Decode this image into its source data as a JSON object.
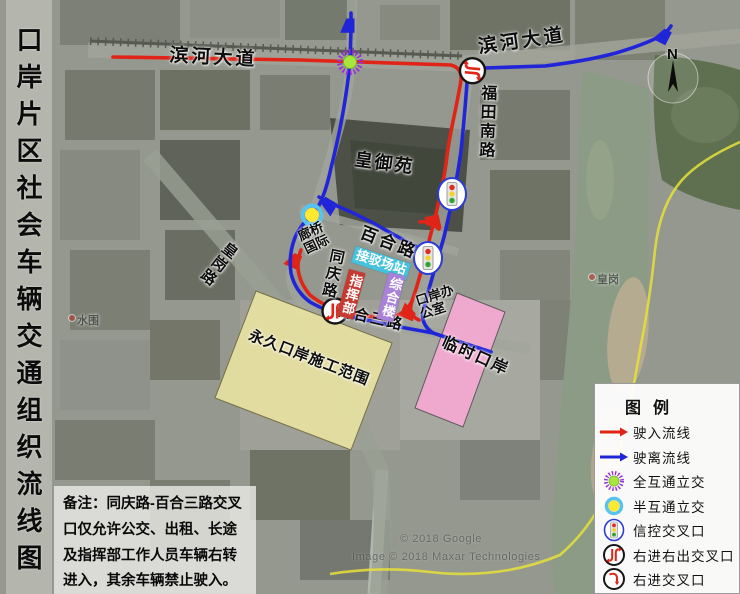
{
  "title": {
    "text": "口岸片区社会车辆交通组织流线图"
  },
  "roads": {
    "binhe_west": "滨河大道",
    "binhe_east": "滨河大道",
    "futian_south": "福田南路",
    "baihe": "百合路",
    "tongqing": "同庆路",
    "huanggang": "皇岗路",
    "baihe_3rd": "百合三路"
  },
  "places": {
    "huangyuyuan": "皇御苑",
    "langqiao_international": "廊桥国际",
    "port_office": "口岸办公室",
    "transfer_station": "接驳场站",
    "command_center": "指挥部",
    "complex_building": "综合楼",
    "permanent_port_area": "永久口岸施工范围",
    "temporary_port": "临时口岸",
    "poi_huanggang": "皇岗",
    "poi_shuiwei": "水围"
  },
  "compass": {
    "label": "N"
  },
  "legend": {
    "title": "图 例",
    "items": [
      {
        "icon": "red-arrow-icon",
        "label": "驶入流线"
      },
      {
        "icon": "blue-arrow-icon",
        "label": "驶离流线"
      },
      {
        "icon": "full-interchange-icon",
        "label": "全互通立交"
      },
      {
        "icon": "half-interchange-icon",
        "label": "半互通立交"
      },
      {
        "icon": "signal-intersection-icon",
        "label": "信控交叉口"
      },
      {
        "icon": "right-in-right-out-icon",
        "label": "右进右出交叉口"
      },
      {
        "icon": "right-in-icon",
        "label": "右进交叉口"
      }
    ]
  },
  "note": {
    "text": "备注：同庆路-百合三路交叉口仅允许公交、出租、长途及指挥部工作人员车辆右转进入，其余车辆禁止驶入。"
  },
  "attribution": {
    "line1": "© 2018 Google",
    "line2": "Image © 2018 Maxar Technologies"
  },
  "colors": {
    "inbound": "#e02418",
    "outbound": "#2025d8",
    "permanent_zone": "#eee7a2",
    "temporary_zone": "#f6aad4",
    "full_interchange_fill": "#a8e63f",
    "full_interchange_ring": "#982fd9",
    "half_interchange_fill": "#ffe92e",
    "half_interchange_ring": "#57c3ee"
  }
}
